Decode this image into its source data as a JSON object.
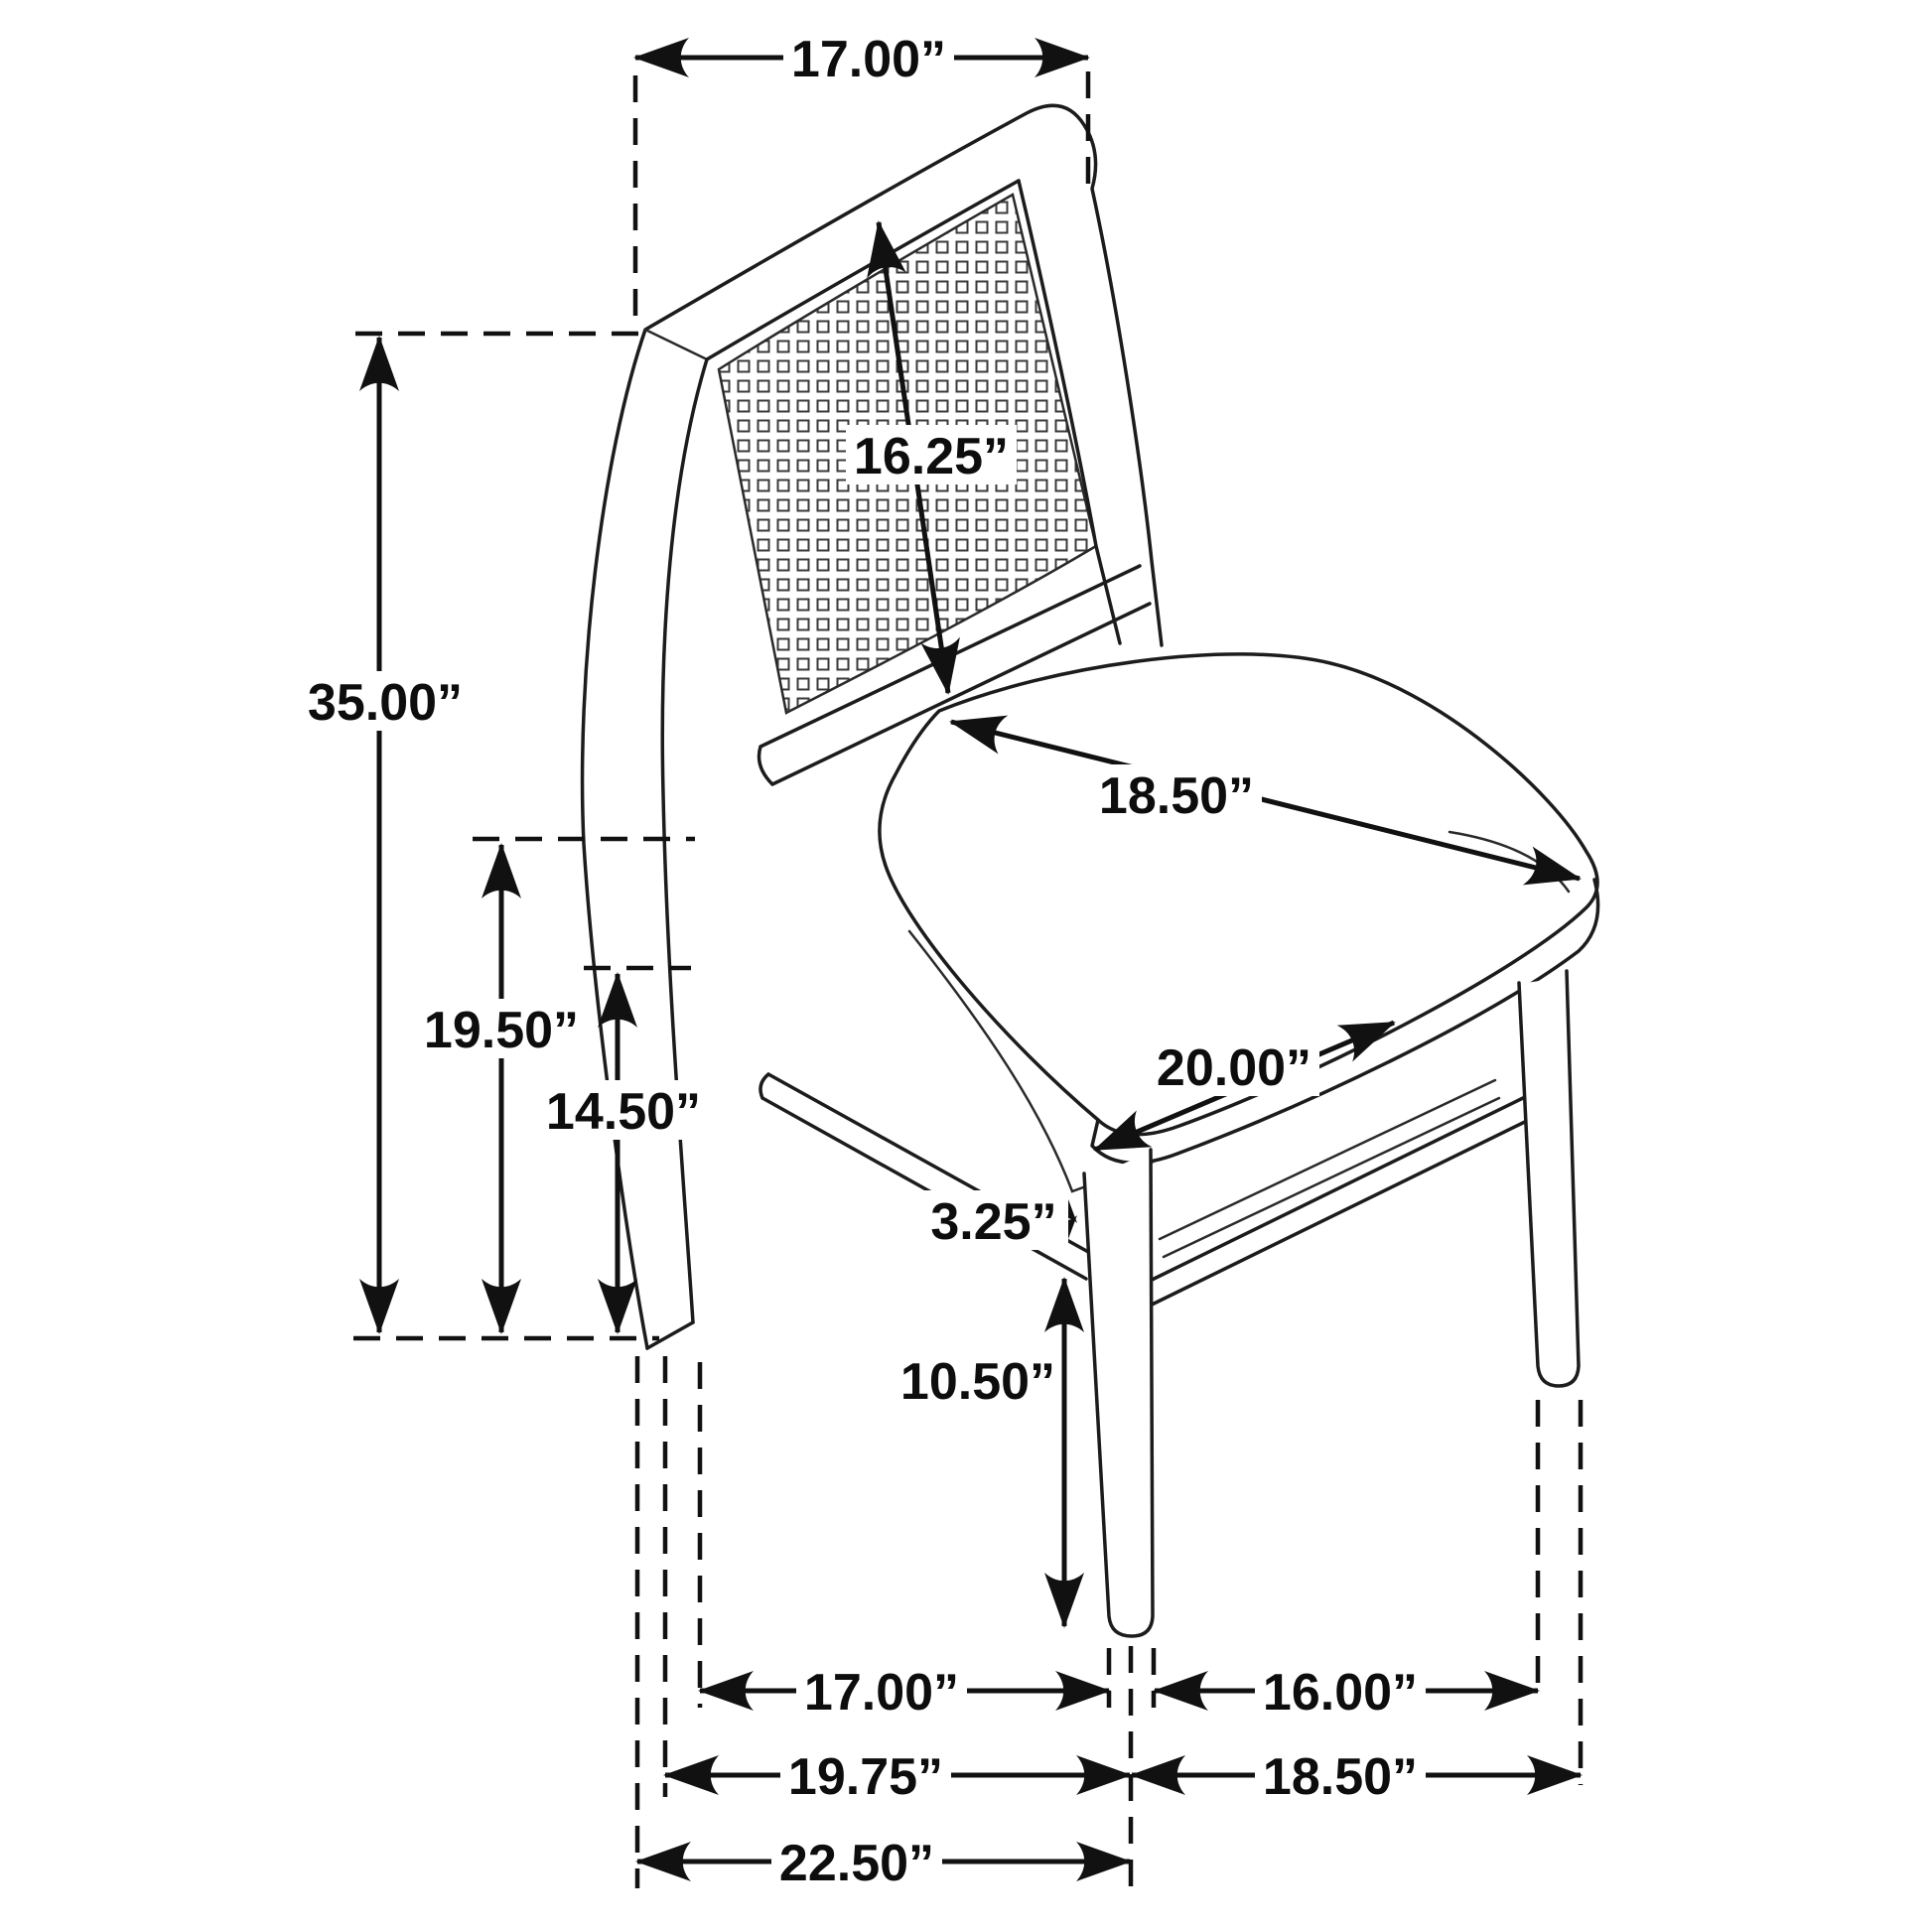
{
  "diagram": {
    "type": "furniture-dimension-drawing",
    "subject": "dining side chair with cane back and upholstered seat",
    "unit": "inches",
    "labels": {
      "back_top_width": "17.00”",
      "back_diagonal": "16.25”",
      "overall_height": "35.00”",
      "seat_height": "19.50”",
      "stretcher_height": "14.50”",
      "seat_depth": "18.50”",
      "seat_width": "20.00”",
      "apron_stretcher_gap": "3.25”",
      "front_leg_height": "10.50”",
      "leg_span_side": "17.00”",
      "leg_span_front": "16.00”",
      "footprint_depth": "19.75”",
      "footprint_width": "18.50”",
      "overall_depth": "22.50”"
    }
  }
}
